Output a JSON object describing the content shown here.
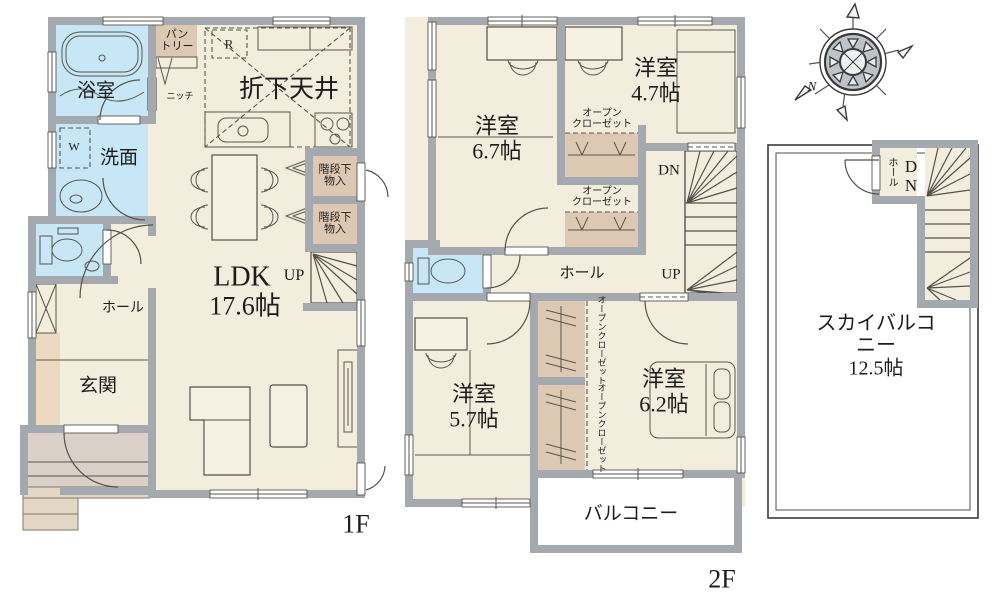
{
  "colors": {
    "wall": "#a4a9b0",
    "room_cream": "#f3edde",
    "water_blue": "#c7e6f6",
    "closet_tan": "#ddc8b3",
    "porch": "#dbd0c8",
    "step": "#e3d6c4",
    "balcony_white": "#ffffff",
    "text": "#1c1c1c"
  },
  "floor1": {
    "floor_label": "1F",
    "bath": "浴室",
    "pantry": "パン\nトリー",
    "niche": "ニッチ",
    "dropped_ceiling": "折下天井",
    "fridge": "R",
    "washer": "W",
    "washroom": "洗面",
    "hall": "ホール",
    "entrance": "玄関",
    "ldk": "LDK",
    "up": "UP",
    "ldk_size": "17.6帖",
    "stair_storage": "階段下\n物入"
  },
  "floor2": {
    "floor_label": "2F",
    "room_67": "洋室\n6.7帖",
    "room_47": "洋室\n4.7帖",
    "room_57": "洋室\n5.7帖",
    "room_62": "洋室\n6.2帖",
    "open_closet": "オープン\nクローゼット",
    "open_closet_vertical": "オープンクローゼット",
    "hall": "ホール",
    "up": "UP",
    "dn": "DN",
    "balcony": "バルコニー"
  },
  "sky": {
    "label": "スカイバルコニー\n12.5帖",
    "hall": "ホール",
    "dn": "DN",
    "compass_north": "N"
  }
}
